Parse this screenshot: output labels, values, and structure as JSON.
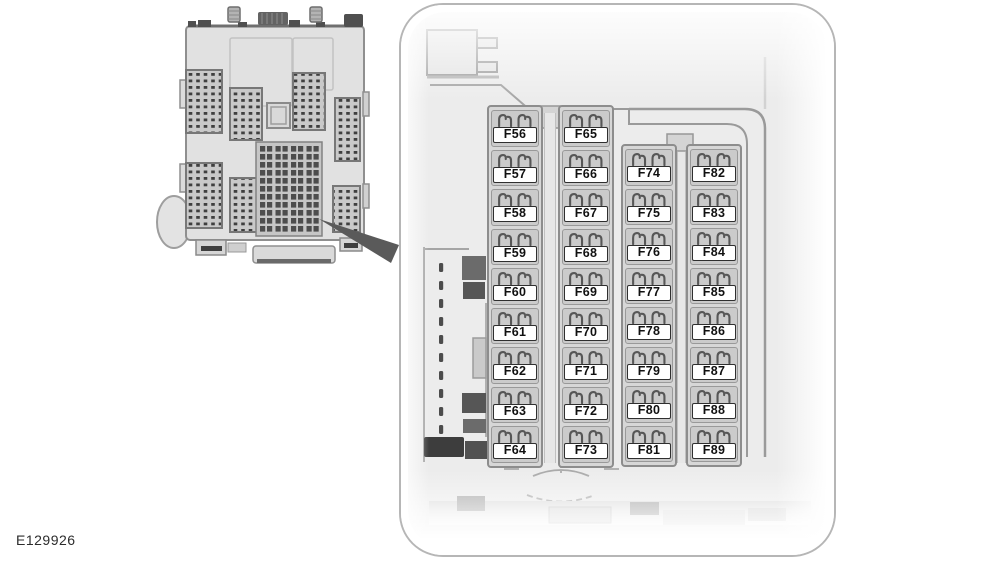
{
  "figure": {
    "code_label": "E129926"
  },
  "icons": {
    "overview_illustration": "fuse-box-module-top-view",
    "callout_pointer": "magnifier-callout-wedge",
    "fuse_prongs": "mini-fuse-terminals"
  },
  "colors": {
    "page_bg": "#ffffff",
    "panel_interior": "#ececec",
    "panel_border": "#b6b6b6",
    "column_bg": "#d7d7d7",
    "cell_bg": "#cbcbcb",
    "outline": "#9a9a9a",
    "dark_part": "#4c4c4c",
    "fuse_label_bg": "#ffffff",
    "fuse_label_border": "#2f2f2f",
    "text": "#101010"
  },
  "detail_view": {
    "fuse_columns": [
      {
        "id": "column-1",
        "start_row": 0,
        "fuses": [
          "F56",
          "F57",
          "F58",
          "F59",
          "F60",
          "F61",
          "F62",
          "F63",
          "F64"
        ]
      },
      {
        "id": "column-2",
        "start_row": 0,
        "fuses": [
          "F65",
          "F66",
          "F67",
          "F68",
          "F69",
          "F70",
          "F71",
          "F72",
          "F73"
        ]
      },
      {
        "id": "column-3",
        "start_row": 1,
        "fuses": [
          "F74",
          "F75",
          "F76",
          "F77",
          "F78",
          "F79",
          "F80",
          "F81"
        ]
      },
      {
        "id": "column-4",
        "start_row": 1,
        "fuses": [
          "F82",
          "F83",
          "F84",
          "F85",
          "F86",
          "F87",
          "F88",
          "F89"
        ]
      }
    ]
  }
}
